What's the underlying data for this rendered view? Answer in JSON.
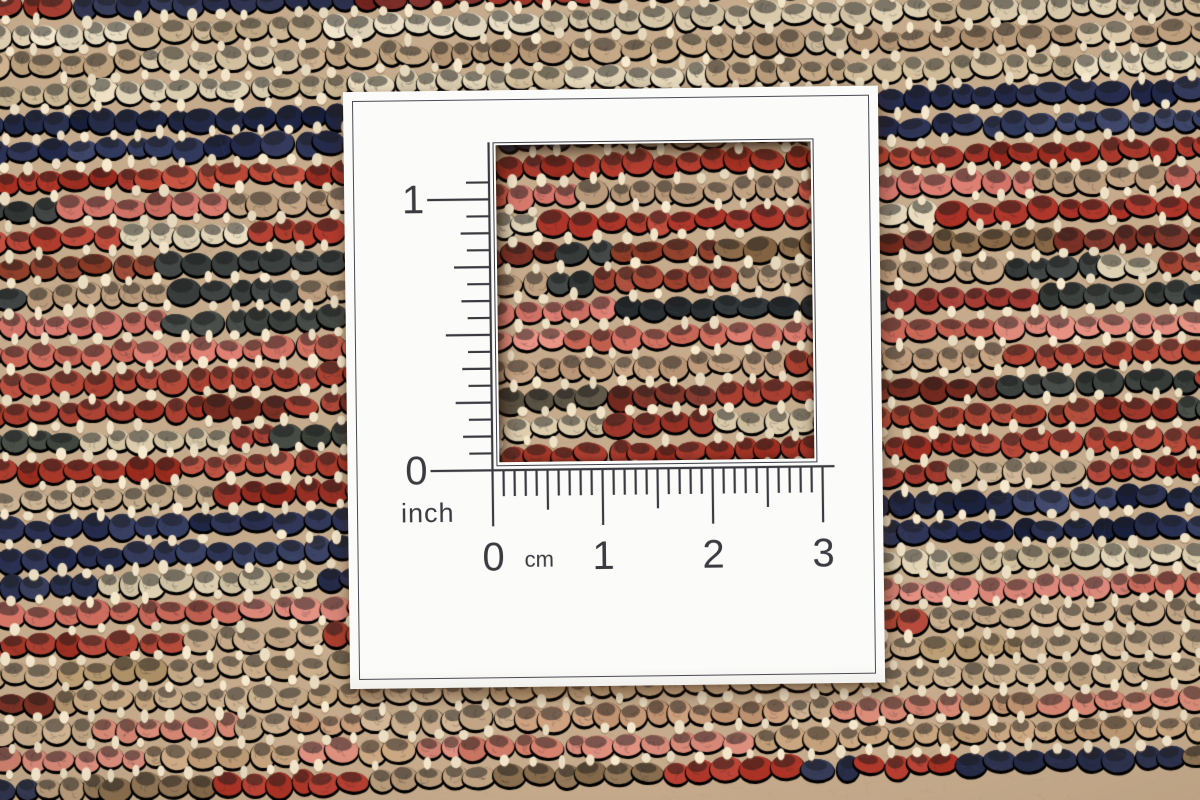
{
  "card": {
    "card_color": "#fbfbf9",
    "ink_color": "#3a3a40",
    "inch_scale": {
      "labels": [
        "1",
        "0"
      ],
      "unit_label": "inch",
      "divisions_per_inch": 16
    },
    "cm_scale": {
      "labels": [
        "0",
        "1",
        "2",
        "3"
      ],
      "unit_label": "cm",
      "divisions_per_cm": 10
    }
  },
  "carpet": {
    "base_color": "#c5ab8c",
    "warp_color": "#ecdfc4",
    "tilt": -0.029,
    "row_height": 29,
    "knot_width": 27,
    "knot_height": 22,
    "rows": [
      {
        "y": 8,
        "colors": [
          "#2e3450",
          "#7a2b26",
          "#a03a2e",
          "#c9b094"
        ],
        "w": [
          4,
          3,
          2,
          2
        ]
      },
      {
        "y": 37,
        "colors": [
          "#e8dcc2",
          "#d9c9ab",
          "#c9b28f"
        ],
        "w": [
          5,
          3,
          2
        ]
      },
      {
        "y": 66,
        "colors": [
          "#c4a885",
          "#b69877",
          "#d5c3a4"
        ],
        "w": [
          5,
          3,
          2
        ]
      },
      {
        "y": 95,
        "colors": [
          "#e3d6b9",
          "#cdb996",
          "#bfa380"
        ],
        "w": [
          4,
          3,
          2
        ]
      },
      {
        "y": 124,
        "colors": [
          "#2b3152",
          "#232a47",
          "#3b4366"
        ],
        "w": [
          5,
          3,
          2
        ]
      },
      {
        "y": 153,
        "colors": [
          "#2b3152",
          "#3b4366",
          "#b7a183"
        ],
        "w": [
          5,
          2,
          2
        ]
      },
      {
        "y": 182,
        "colors": [
          "#b23a2c",
          "#a23226",
          "#c04c3a"
        ],
        "w": [
          5,
          3,
          2
        ]
      },
      {
        "y": 211,
        "colors": [
          "#c25040",
          "#3c4140",
          "#bfa080",
          "#d4766a"
        ],
        "w": [
          4,
          2,
          3,
          2
        ]
      },
      {
        "y": 240,
        "colors": [
          "#ab3327",
          "#b84535",
          "#e2d5b8"
        ],
        "w": [
          5,
          3,
          2
        ]
      },
      {
        "y": 269,
        "colors": [
          "#7e3428",
          "#95442f",
          "#8a6a48",
          "#3c4140"
        ],
        "w": [
          4,
          3,
          2,
          1
        ]
      },
      {
        "y": 298,
        "colors": [
          "#bfa080",
          "#a84a38",
          "#e0d2b4",
          "#3c4140"
        ],
        "w": [
          4,
          3,
          2,
          1
        ]
      },
      {
        "y": 327,
        "colors": [
          "#a84038",
          "#3f4440",
          "#d4766a",
          "#2f3437"
        ],
        "w": [
          4,
          2,
          3,
          1
        ]
      },
      {
        "y": 356,
        "colors": [
          "#d8786a",
          "#cc6a5a",
          "#e08a7c",
          "#b5503f"
        ],
        "w": [
          4,
          3,
          2,
          2
        ]
      },
      {
        "y": 385,
        "colors": [
          "#b34a3a",
          "#a83a2c",
          "#c29f7e"
        ],
        "w": [
          5,
          3,
          2
        ]
      },
      {
        "y": 414,
        "colors": [
          "#a83f30",
          "#5a5242",
          "#7e3428",
          "#3f4440"
        ],
        "w": [
          4,
          2,
          2,
          2
        ]
      },
      {
        "y": 443,
        "colors": [
          "#a13a2e",
          "#41463f",
          "#b04a38",
          "#d5c5a5"
        ],
        "w": [
          4,
          2,
          3,
          1
        ]
      },
      {
        "y": 472,
        "colors": [
          "#b04232",
          "#c05544",
          "#a53628"
        ],
        "w": [
          4,
          3,
          3
        ]
      },
      {
        "y": 501,
        "colors": [
          "#9c3328",
          "#b04538",
          "#c9b191"
        ],
        "w": [
          5,
          3,
          2
        ]
      },
      {
        "y": 530,
        "colors": [
          "#2b3152",
          "#222946",
          "#3b4366"
        ],
        "w": [
          5,
          3,
          2
        ]
      },
      {
        "y": 559,
        "colors": [
          "#2b3152",
          "#343c5e",
          "#222946"
        ],
        "w": [
          5,
          3,
          2
        ]
      },
      {
        "y": 588,
        "colors": [
          "#d9cbac",
          "#2f3654",
          "#c8b694"
        ],
        "w": [
          4,
          2,
          3
        ]
      },
      {
        "y": 617,
        "colors": [
          "#d47566",
          "#dd8a7c",
          "#c86858"
        ],
        "w": [
          4,
          3,
          2
        ]
      },
      {
        "y": 646,
        "colors": [
          "#b04434",
          "#a63a2c",
          "#c9ad8c"
        ],
        "w": [
          5,
          3,
          1
        ]
      },
      {
        "y": 675,
        "colors": [
          "#c2a683",
          "#b6986f",
          "#ccb290"
        ],
        "w": [
          5,
          3,
          3
        ]
      },
      {
        "y": 704,
        "colors": [
          "#c6ab89",
          "#7e3428",
          "#bfa07a"
        ],
        "w": [
          5,
          2,
          3
        ]
      },
      {
        "y": 733,
        "colors": [
          "#c9ad8c",
          "#d88a76",
          "#c79a78"
        ],
        "w": [
          4,
          3,
          2
        ]
      },
      {
        "y": 762,
        "colors": [
          "#d88978",
          "#c7a47e",
          "#cf7a66"
        ],
        "w": [
          4,
          3,
          2
        ]
      },
      {
        "y": 791,
        "colors": [
          "#bfa281",
          "#2e3450",
          "#8a6f50",
          "#b23a2c"
        ],
        "w": [
          4,
          2,
          2,
          2
        ]
      }
    ]
  }
}
